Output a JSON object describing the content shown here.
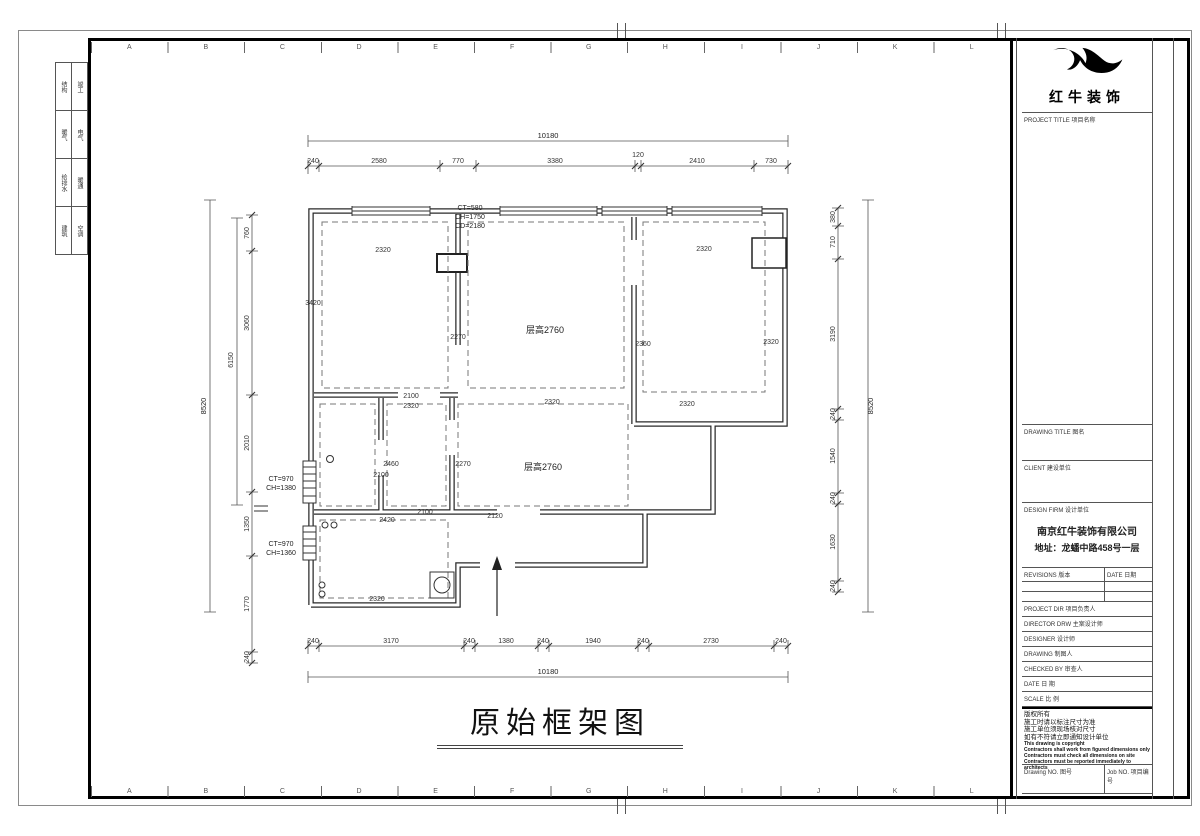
{
  "sheet": {
    "grid_letters": [
      "A",
      "B",
      "C",
      "D",
      "E",
      "F",
      "G",
      "H",
      "I",
      "J",
      "K",
      "L"
    ],
    "signoff": [
      {
        "a": "结构",
        "b": "竣工"
      },
      {
        "a": "暖气",
        "b": "电气"
      },
      {
        "a": "给排水",
        "b": "暖通"
      },
      {
        "a": "建筑",
        "b": "空调"
      }
    ]
  },
  "plan": {
    "title": "原始框架图",
    "room_upper": "层高2760",
    "room_lower": "层高2760",
    "notes": {
      "top_window": [
        "CT=580",
        "CH=1750",
        "CD=2180"
      ],
      "left_window_1": [
        "CT=970",
        "CH=1380"
      ],
      "left_window_2": [
        "CT=970",
        "CH=1360"
      ]
    },
    "dims": {
      "top_total": "10180",
      "top": [
        "240",
        "2580",
        "770",
        "3380",
        "120",
        "2410",
        "730"
      ],
      "bottom_total": "10180",
      "bottom": [
        "240",
        "3170",
        "240",
        "1380",
        "240",
        "1940",
        "240",
        "2730",
        "240"
      ],
      "left_total": "8520",
      "left_mid": "6150",
      "left": [
        "760",
        "3060",
        "2010",
        "1350",
        "1770",
        "240"
      ],
      "right_total": "8520",
      "right": [
        "380",
        "710",
        "3190",
        "240",
        "1540",
        "240",
        "1630",
        "240"
      ],
      "interior": {
        "room1_top": "2320",
        "room1_left": "3420",
        "mid_left": "2270",
        "mid_right": "2360",
        "mid_bottom": "2320",
        "right_top": "2320",
        "right_right": "2320",
        "right_bottom": "2320",
        "sr_top1": "2100",
        "sr_top2": "2320",
        "sr_w": "2460",
        "sr_w2": "2100",
        "low_left": "2270",
        "low_bottom": "2120",
        "entry_w": "2100",
        "kitchen_top": "2420",
        "kitchen_bottom": "2320"
      }
    }
  },
  "titleblock": {
    "brand": "红牛装饰",
    "project_title_label": "PROJECT TITLE 项目名称",
    "drawing_title_label": "DRAWING TITLE 图名",
    "client_label": "CLIENT 建设单位",
    "design_firm_label": "DESIGN FIRM 设计单位",
    "firm_name": "南京红牛装饰有限公司",
    "firm_address": "地址：龙蟠中路458号一层",
    "revisions_label": "REVISIONS 版本",
    "revisions_date_label": "DATE 日期",
    "rows": [
      {
        "label": "PROJECT DIR  项目负责人"
      },
      {
        "label": "DIRECTOR DRW 主案设计师"
      },
      {
        "label": "DESIGNER  设计师"
      },
      {
        "label": "DRAWING  制图人"
      },
      {
        "label": "CHECKED BY  审查人"
      },
      {
        "label": "DATE  日 期"
      },
      {
        "label": "SCALE  比 例"
      }
    ],
    "copyright": [
      "版权所有",
      "施工时请以标注尺寸为准",
      "施工单位须现场核对尺寸",
      "如有不符请立即通知设计单位",
      "This drawing is copyright",
      "Contractors shall work from figured dimensions only",
      "Contractors must check all dimensions on site",
      "Contractors must be reported immediately to architects"
    ],
    "drawing_no_label": "Drawing NO. 图号",
    "job_no_label": "Job NO. 项目编号"
  }
}
